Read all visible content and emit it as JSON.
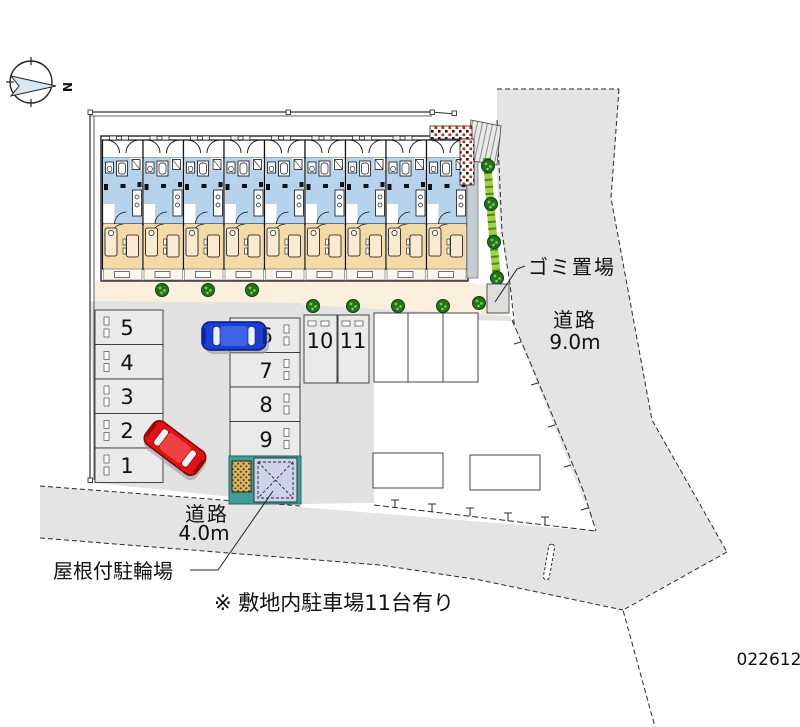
{
  "compass": {
    "north_label": "N"
  },
  "labels": {
    "garbage_area": "ゴミ置場",
    "road_east_name": "道路",
    "road_east_width": "9.0m",
    "road_south_name": "道路",
    "road_south_width": "4.0m",
    "covered_bicycle_parking": "屋根付駐輪場",
    "site_note": "※ 敷地内駐車場11台有り",
    "drawing_number": "022612"
  },
  "parking_spaces": {
    "left_column": [
      "5",
      "4",
      "3",
      "2",
      "1"
    ],
    "right_column": [
      "6",
      "7",
      "8",
      "9"
    ],
    "top_row": [
      "10",
      "11"
    ]
  },
  "colors": {
    "road_gray": "#e4e4e4",
    "parking_gray": "#e2e2e2",
    "stall_gray": "#eaeaea",
    "walkway_cream": "#faeedd",
    "room_blue": "#b5d3ec",
    "room_tan": "#f4daa6",
    "hedge_green": "#a3d045",
    "bush_green": "#22751c",
    "car_blue": "#1b3fd6",
    "car_red": "#e01212",
    "bike_roof_lavender": "#cdd4ea",
    "teal_wall": "#3f9e97",
    "accent_red_dots": "#cc2200"
  }
}
